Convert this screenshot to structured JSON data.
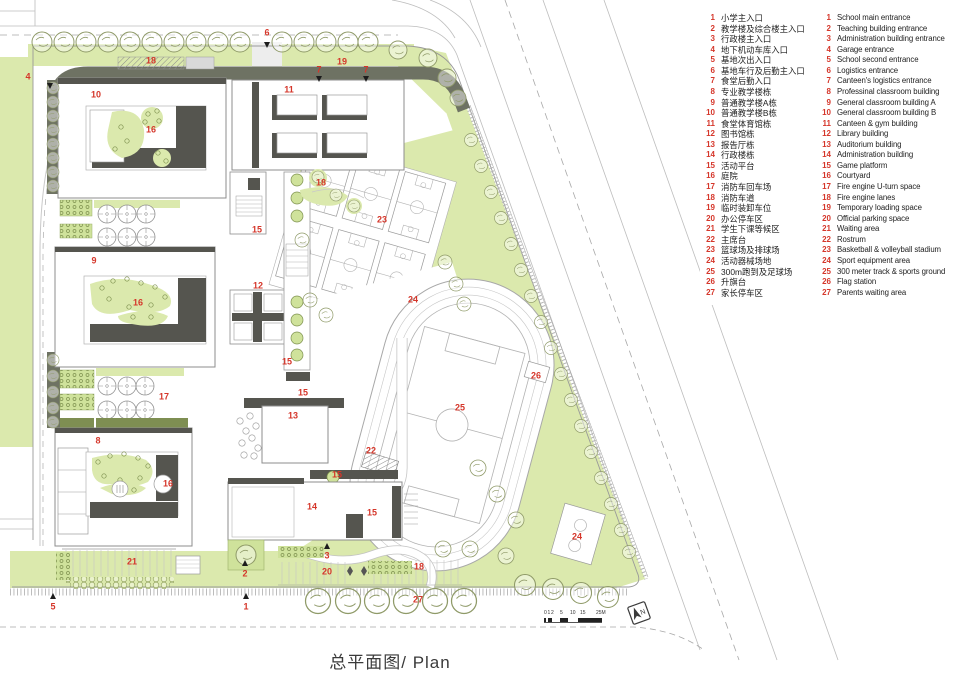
{
  "title": {
    "text": "总平面图/ Plan"
  },
  "north": {
    "label": "N"
  },
  "scale_bar": {
    "labels": [
      "0",
      "1",
      "2",
      "5",
      "10",
      "15",
      "25M"
    ]
  },
  "colors": {
    "marker_red": "#d5362a",
    "green_light": "#dbe9ad",
    "green_planter": "#cfe29b",
    "dark_wall": "#55554f",
    "fire_lane_gray": "#6e7263"
  },
  "legend": {
    "items": [
      {
        "num": "1",
        "zh": "小学主入口",
        "en": "School main entrance"
      },
      {
        "num": "2",
        "zh": "教学楼及综合楼主入口",
        "en": "Teaching building entrance"
      },
      {
        "num": "3",
        "zh": "行政楼主入口",
        "en": "Administration building entrance"
      },
      {
        "num": "4",
        "zh": "地下机动车库入口",
        "en": "Garage entrance"
      },
      {
        "num": "5",
        "zh": "基地次出入口",
        "en": "School second entrance"
      },
      {
        "num": "6",
        "zh": "基地车行及后勤主入口",
        "en": "Logistics entrance"
      },
      {
        "num": "7",
        "zh": "食堂后勤入口",
        "en": "Canteen's logistics entrance"
      },
      {
        "num": "8",
        "zh": "专业教学楼栋",
        "en": "Professinal classroom building"
      },
      {
        "num": "9",
        "zh": "普通教学楼A栋",
        "en": "General classroom building A"
      },
      {
        "num": "10",
        "zh": "普通教学楼B栋",
        "en": "General classroom building B"
      },
      {
        "num": "11",
        "zh": "食堂体育馆栋",
        "en": "Canteen & gym building"
      },
      {
        "num": "12",
        "zh": "图书馆栋",
        "en": "Library building"
      },
      {
        "num": "13",
        "zh": "报告厅栋",
        "en": "Auditorium building"
      },
      {
        "num": "14",
        "zh": "行政楼栋",
        "en": "Administration building"
      },
      {
        "num": "15",
        "zh": "活动平台",
        "en": "Game platform"
      },
      {
        "num": "16",
        "zh": "庭院",
        "en": "Courtyard"
      },
      {
        "num": "17",
        "zh": "消防车回车场",
        "en": "Fire engine U-turn space"
      },
      {
        "num": "18",
        "zh": "消防车道",
        "en": "Fire engine lanes"
      },
      {
        "num": "19",
        "zh": "临时装卸车位",
        "en": "Temporary loading space"
      },
      {
        "num": "20",
        "zh": "办公停车区",
        "en": "Official parking space"
      },
      {
        "num": "21",
        "zh": "学生下课等候区",
        "en": "Waiting area"
      },
      {
        "num": "22",
        "zh": "主席台",
        "en": "Rostrum"
      },
      {
        "num": "23",
        "zh": "篮球场及排球场",
        "en": "Basketball & volleyball stadium"
      },
      {
        "num": "24",
        "zh": "活动器械场地",
        "en": "Sport equipment area"
      },
      {
        "num": "25",
        "zh": "300m跑到及足球场",
        "en": "300 meter track & sports ground"
      },
      {
        "num": "26",
        "zh": "升旗台",
        "en": "Flag station"
      },
      {
        "num": "27",
        "zh": "家长停车区",
        "en": "Parents waiting area"
      }
    ]
  },
  "plan": {
    "markers": [
      {
        "label": "1",
        "x": 246,
        "y": 607
      },
      {
        "label": "2",
        "x": 245,
        "y": 574
      },
      {
        "label": "3",
        "x": 327,
        "y": 556
      },
      {
        "label": "4",
        "x": 28,
        "y": 77
      },
      {
        "label": "5",
        "x": 53,
        "y": 607
      },
      {
        "label": "6",
        "x": 267,
        "y": 33
      },
      {
        "label": "7",
        "x": 319,
        "y": 70
      },
      {
        "label": "7",
        "x": 366,
        "y": 70
      },
      {
        "label": "8",
        "x": 98,
        "y": 441
      },
      {
        "label": "9",
        "x": 94,
        "y": 261
      },
      {
        "label": "10",
        "x": 96,
        "y": 95
      },
      {
        "label": "11",
        "x": 289,
        "y": 90
      },
      {
        "label": "12",
        "x": 258,
        "y": 286
      },
      {
        "label": "13",
        "x": 293,
        "y": 416
      },
      {
        "label": "14",
        "x": 312,
        "y": 507
      },
      {
        "label": "15",
        "x": 257,
        "y": 230
      },
      {
        "label": "15",
        "x": 287,
        "y": 362
      },
      {
        "label": "15",
        "x": 303,
        "y": 393
      },
      {
        "label": "15",
        "x": 337,
        "y": 475
      },
      {
        "label": "15",
        "x": 372,
        "y": 513
      },
      {
        "label": "16",
        "x": 151,
        "y": 130
      },
      {
        "label": "16",
        "x": 138,
        "y": 303
      },
      {
        "label": "16",
        "x": 168,
        "y": 484
      },
      {
        "label": "17",
        "x": 164,
        "y": 397
      },
      {
        "label": "18",
        "x": 151,
        "y": 61
      },
      {
        "label": "18",
        "x": 321,
        "y": 183
      },
      {
        "label": "18",
        "x": 419,
        "y": 567
      },
      {
        "label": "19",
        "x": 342,
        "y": 62
      },
      {
        "label": "20",
        "x": 327,
        "y": 572
      },
      {
        "label": "21",
        "x": 132,
        "y": 562
      },
      {
        "label": "22",
        "x": 371,
        "y": 451
      },
      {
        "label": "23",
        "x": 382,
        "y": 220
      },
      {
        "label": "24",
        "x": 413,
        "y": 300
      },
      {
        "label": "24",
        "x": 577,
        "y": 537
      },
      {
        "label": "25",
        "x": 460,
        "y": 408
      },
      {
        "label": "26",
        "x": 536,
        "y": 376
      },
      {
        "label": "27",
        "x": 418,
        "y": 600
      }
    ],
    "entrances": [
      {
        "x": 267,
        "y": 45,
        "dir": "down"
      },
      {
        "x": 319,
        "y": 79,
        "dir": "down"
      },
      {
        "x": 366,
        "y": 79,
        "dir": "down"
      },
      {
        "x": 50,
        "y": 86,
        "dir": "down"
      },
      {
        "x": 53,
        "y": 596,
        "dir": "up"
      },
      {
        "x": 246,
        "y": 596,
        "dir": "up"
      },
      {
        "x": 245,
        "y": 563,
        "dir": "up"
      },
      {
        "x": 327,
        "y": 546,
        "dir": "up"
      }
    ]
  }
}
